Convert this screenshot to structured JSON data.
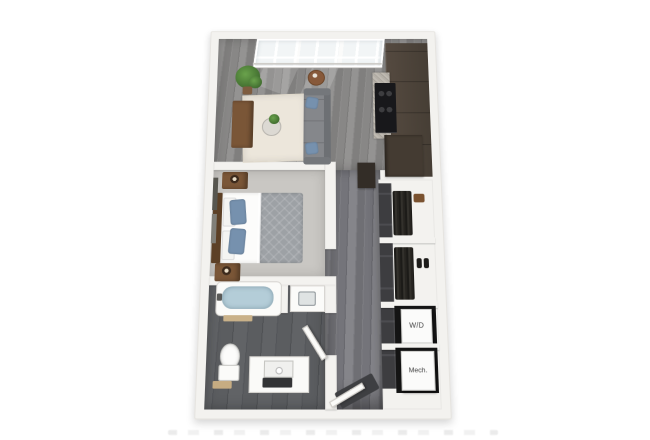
{
  "plan": {
    "type": "3d-floor-plan-render",
    "subject": "studio-apartment-unit",
    "labels": {
      "washer_dryer": "W/D",
      "mechanical": "Mech."
    },
    "rooms": [
      "living-area",
      "kitchen",
      "bedroom",
      "bathroom",
      "hallway",
      "entry",
      "reach-in-closets",
      "washer-dryer-closet",
      "mechanical-closet"
    ],
    "furniture": [
      "window-wall",
      "sectional-sofa",
      "throw-pillows",
      "area-rug",
      "coffee-table",
      "media-console",
      "potted-plant",
      "round-side-table",
      "refrigerator-cabinet",
      "cooktop",
      "kitchen-counter",
      "kitchen-island",
      "bed",
      "headboard",
      "nightstands",
      "table-lamps",
      "wall-art",
      "bathtub",
      "bath-mat",
      "toilet",
      "vanity-with-mirror",
      "sink-counter",
      "hanging-clothes",
      "shoes",
      "storage-bag",
      "closet-sliding-doors",
      "entry-door",
      "bathroom-door",
      "door-mat"
    ],
    "colors": {
      "background": "#ffffff",
      "wall": "#f3f2ef",
      "wall_edge": "#e6e4e0",
      "wood_base": "#8a8988",
      "hall_wood_base": "#75757a",
      "carpet": "#c9c7c3",
      "tile": "#5a5c5f",
      "rug": "#ece6db",
      "sofa": "#85878b",
      "sofa_dark": "#6d7074",
      "pillow": "#7691ae",
      "wood_brown": "#7a5637",
      "cabinet": "#4e443a",
      "black": "#18181b",
      "counter": "#b2ada5",
      "green": "#4f7d3b",
      "water": "#b4cdd8",
      "clothes": "#26251f",
      "recess": "#141414",
      "appliance_front": "#fbfbfa",
      "label": "#3f3f3f"
    }
  }
}
